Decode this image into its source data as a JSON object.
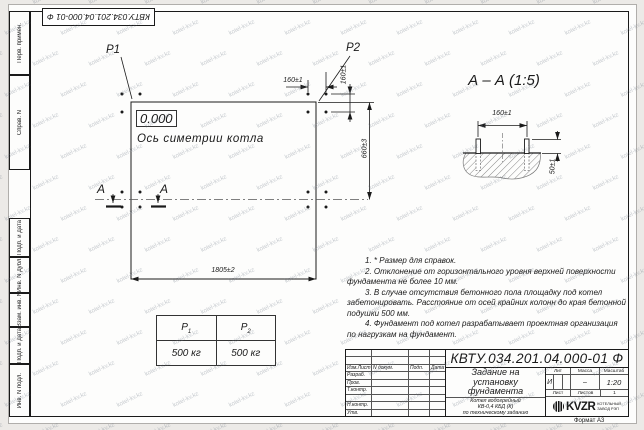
{
  "watermark": {
    "text": "kotel-kv.kz"
  },
  "frame": {
    "top_stamp": "КВТУ.034.201.04.000-01 Ф",
    "format_label": "Формат А3",
    "margin_labels": [
      "Перв. примен.",
      "Справ. N",
      "Подп. и дата",
      "Инв. N дубл.",
      "Взам. инв. N",
      "Подп. и дата",
      "Инв. N подл."
    ]
  },
  "plan": {
    "p1": "P1",
    "p2": "P2",
    "elevation": "0.000",
    "axis_label": "Ось симетрии котла",
    "dim_bolt_spacing_h": "160±1",
    "dim_bolt_spacing_v": "160±1",
    "dim_width": "660±3",
    "dim_length": "1805±2",
    "section_mark_left": "А",
    "section_mark_right": "А"
  },
  "section": {
    "title": "А – А (1:5)",
    "dim_bolt_spacing": "160±1",
    "dim_bolt_height": "50±1"
  },
  "load_table": {
    "headers": [
      {
        "base": "P",
        "sub": "1"
      },
      {
        "base": "P",
        "sub": "2"
      }
    ],
    "values": [
      "500 кг",
      "500 кг"
    ]
  },
  "notes": {
    "lines": [
      "1.  * Размер для справок.",
      "2.  Отклонение от горизонтального уровня верхней поверхности",
      "фундамента не более 10 мм.",
      "3.  В случае отсутствия бетонного пола площадку под котел",
      "забетонировать. Расстояние от осей крайних колонн до края бетонной",
      "подушки 500 мм.",
      "4.  Фундамент под котел разрабатывает проектная организация",
      "по нагрузкам на фундамент."
    ]
  },
  "title_block": {
    "doc_number": "КВТУ.034.201.04.000-01 Ф",
    "title_lines": [
      "Задание на",
      "установку",
      "фундамента"
    ],
    "subtitle_lines": [
      "Котел водогрейный",
      "КВ-0,4  КБД  (К)",
      "по техническому заданию"
    ],
    "header_row": [
      "Изм.Лист",
      "N докум.",
      "Подп.",
      "Дата"
    ],
    "row_labels": [
      "Разраб.",
      "Пров.",
      "Т.контр.",
      "",
      "Н.контр.",
      "Утв."
    ],
    "lit_header": "Лит",
    "massa_header": "Масса",
    "masshtab_header": "Масштаб",
    "lit_value": "И",
    "massa_value": "–",
    "masshtab_value": "1:20",
    "list_label": "Лист",
    "listov_label": "Листов",
    "listov_value": "1",
    "logo_text": "KVZR",
    "logo_sub1": "КОТЕЛЬНЫЙ",
    "logo_sub2": "ЗАВОД РЭП"
  }
}
